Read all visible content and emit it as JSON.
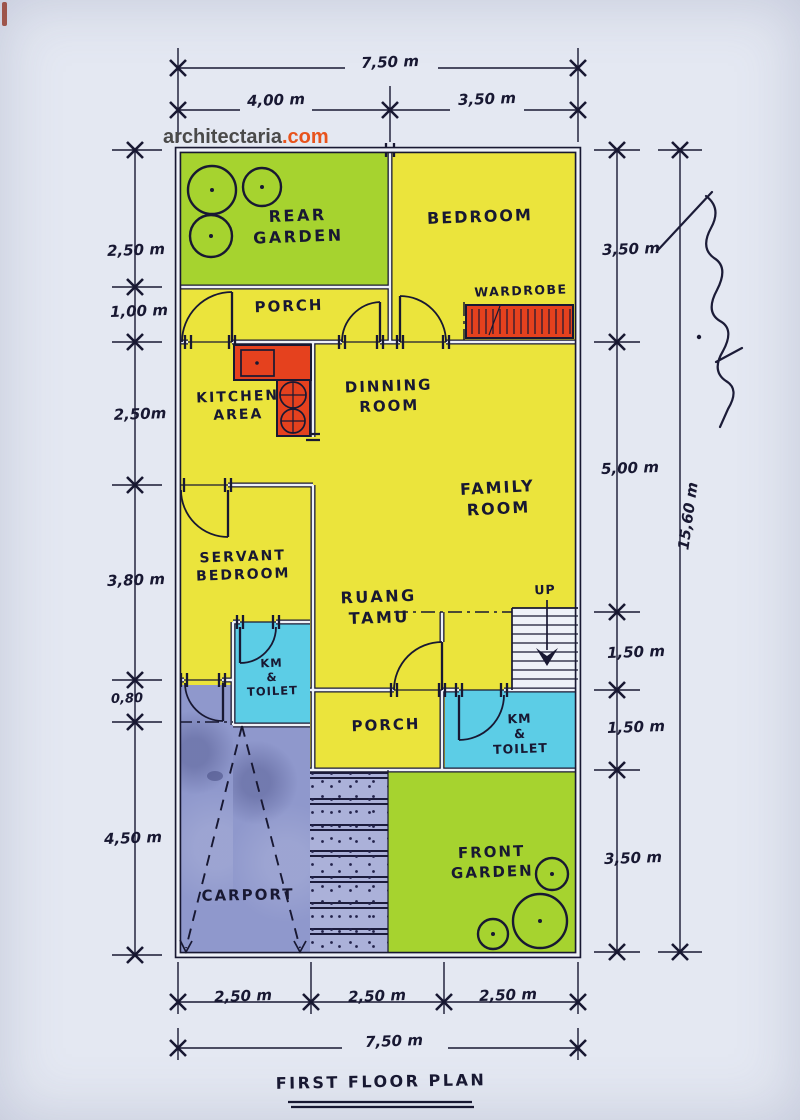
{
  "meta": {
    "watermark_name": "architectaria",
    "watermark_tld": ".com",
    "title": "FIRST FLOOR PLAN"
  },
  "rooms": {
    "rear_garden": {
      "line1": "REAR",
      "line2": "GARDEN"
    },
    "bedroom": {
      "line1": "BEDROOM"
    },
    "porch_top": {
      "line1": "PORCH"
    },
    "wardrobe": {
      "line1": "WARDROBE"
    },
    "kitchen": {
      "line1": "KITCHEN",
      "line2": "AREA"
    },
    "dinning": {
      "line1": "DINNING",
      "line2": "ROOM"
    },
    "family": {
      "line1": "FAMILY",
      "line2": "ROOM"
    },
    "servant": {
      "line1": "SERVANT",
      "line2": "BEDROOM"
    },
    "ruang_tamu": {
      "line1": "RUANG",
      "line2": "TAMU"
    },
    "km_toilet_left": {
      "line1": "KM",
      "line2": "&",
      "line3": "TOILET"
    },
    "km_toilet_right": {
      "line1": "KM",
      "line2": "&",
      "line3": "TOILET"
    },
    "porch_bottom": {
      "line1": "PORCH"
    },
    "carport": {
      "line1": "CARPORT"
    },
    "front_garden": {
      "line1": "FRONT",
      "line2": "GARDEN"
    },
    "stairs": {
      "up_label": "UP"
    }
  },
  "dims": {
    "top_total": "7,50 m",
    "top_left": "4,00 m",
    "top_right": "3,50 m",
    "left_1": "2,50 m",
    "left_2": "1,00 m",
    "left_3": "2,50m",
    "left_4": "3,80 m",
    "left_5": "0,80",
    "left_6": "4,50 m",
    "right_1": "3,50 m",
    "right_2": "5,00 m",
    "right_3": "1,50 m",
    "right_4": "1,50 m",
    "right_5": "3,50 m",
    "right_total": "15,60 m",
    "bottom_1": "2,50 m",
    "bottom_2": "2,50 m",
    "bottom_3": "2,50 m",
    "bottom_total": "7,50 m"
  },
  "colors": {
    "paper": "#e4e8f2",
    "paper_core": "#eef1f8",
    "ink": "#181832",
    "garden": "#a6d32f",
    "room": "#ebe43c",
    "wet": "#5ccde6",
    "pave": "#8f98cc",
    "walk": "#abb1d9",
    "counter": "#e5411e",
    "watermark_gray": "#4a4a4a",
    "watermark_orange": "#e8531d"
  }
}
